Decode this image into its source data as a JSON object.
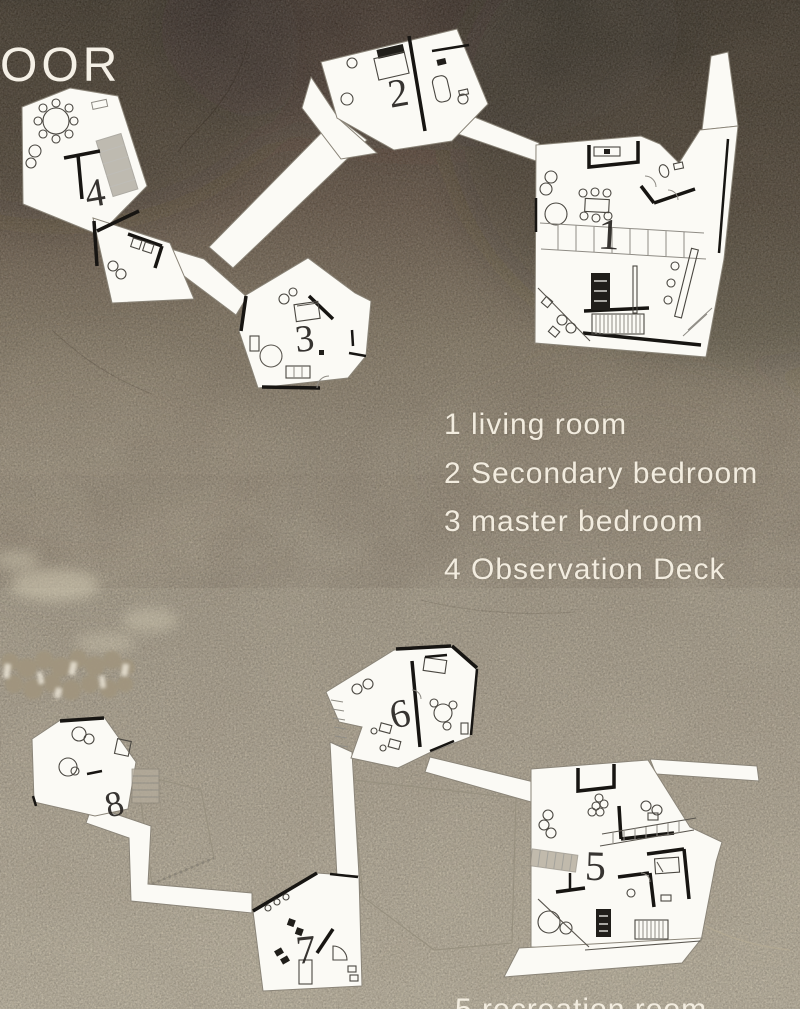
{
  "poster": {
    "upper_floor_label_partial": "OOR",
    "legend": {
      "items": [
        "1 living room",
        "2 Secondary bedroom",
        "3 master bedroom",
        "4 Observation Deck"
      ]
    },
    "lower_legend_partial_line": "5 recreation room",
    "room_numbers": {
      "living_room": "1",
      "secondary_bedroom": "2",
      "master_bedroom": "3",
      "observation_deck": "4",
      "r5": "5",
      "r6": "6",
      "r7": "7",
      "r8": "8"
    },
    "colors": {
      "background_top": "#46392e",
      "background_middle": "#ab9f89",
      "background_bottom": "#cfc5ae",
      "plan_paper": "#fbfaf5",
      "text": "#f2ecdf"
    }
  }
}
